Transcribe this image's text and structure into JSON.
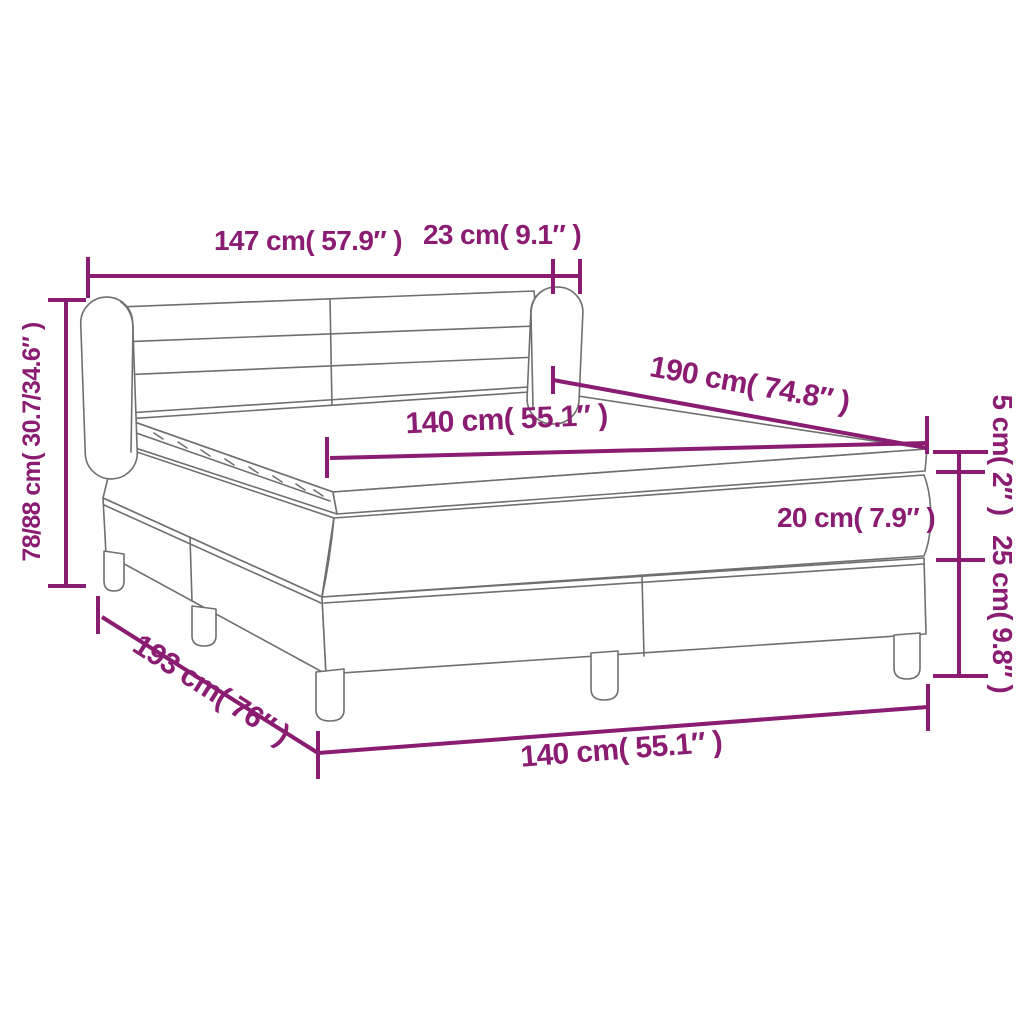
{
  "diagram": {
    "title": "box-spring-bed-dimension-diagram",
    "colors": {
      "dimension": "#8A1C72",
      "outline": "#6f6f6f"
    },
    "labels": {
      "headboard_width": "147 cm( 57.9″ )",
      "headboard_wing_depth": "23 cm( 9.1″ )",
      "total_height": "78/88 cm( 30.7/34.6″ )",
      "mattress_length": "190 cm( 74.8″ )",
      "mattress_width": "140 cm( 55.1″ )",
      "topper_height": "5 cm( 2″ )",
      "mattress_height": "20 cm( 7.9″ )",
      "base_height": "25 cm( 9.8″ )",
      "base_length": "193 cm( 76″ )",
      "base_width": "140 cm( 55.1″ )"
    }
  }
}
